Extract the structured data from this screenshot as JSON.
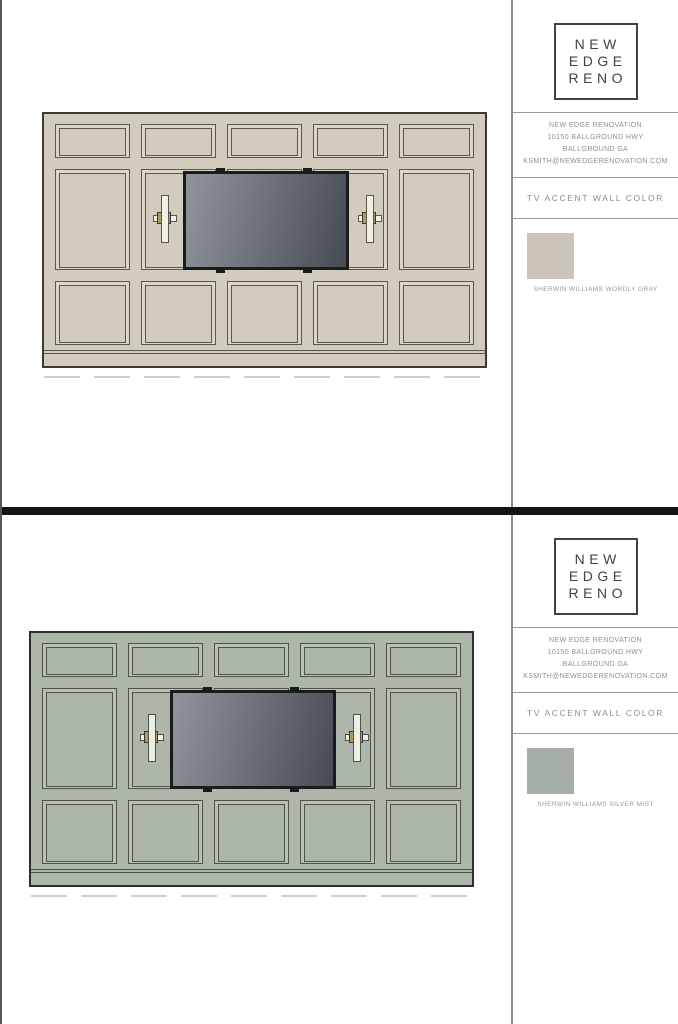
{
  "divider_color": "#141418",
  "brand": {
    "logo_lines": [
      "NEW",
      "EDGE",
      "RENO"
    ]
  },
  "tv": {
    "frame_color": "#191B1F",
    "screen_gradient_start": "#8F959C",
    "screen_gradient_end": "#474B52"
  },
  "sections": [
    {
      "name": "Worldly Gray option",
      "contact_lines": [
        "NEW EDGE RENOVATION",
        "10150 BALLGROUND HWY",
        "BALLGROUND GA",
        "KSMITH@NEWEDGERENOVATION.COM"
      ],
      "panel_title": "TV ACCENT WALL COLOR",
      "swatch_label": "SHERWIN WILLIAMS WORDLY GRAY",
      "colors": {
        "swatch": "#CAC5B8",
        "wall_base": "#D2CCBF",
        "wall_highlight": "#DCD6C9",
        "wall_line": "#5A574D",
        "wall_outline": "#3B3930",
        "sconce_tube": "#F2EFE6",
        "sconce_brass": "#AB9D5F"
      }
    },
    {
      "name": "Silver Mist option",
      "contact_lines": [
        "NEW EDGE RENOVATION",
        "10150 BALLGROUND HWY",
        "BALLGROUND GA",
        "KSMITH@NEWEDGERENOVATION.COM"
      ],
      "panel_title": "TV ACCENT WALL COLOR",
      "swatch_label": "SHERWIN WILLIAMS SILVER MIST",
      "colors": {
        "swatch": "#A5AFA6",
        "wall_base": "#ACB6AB",
        "wall_highlight": "#B8C1B6",
        "wall_line": "#4D5349",
        "wall_outline": "#2C302A",
        "sconce_tube": "#EBEFE6",
        "sconce_brass": "#AB9D5F"
      }
    }
  ]
}
